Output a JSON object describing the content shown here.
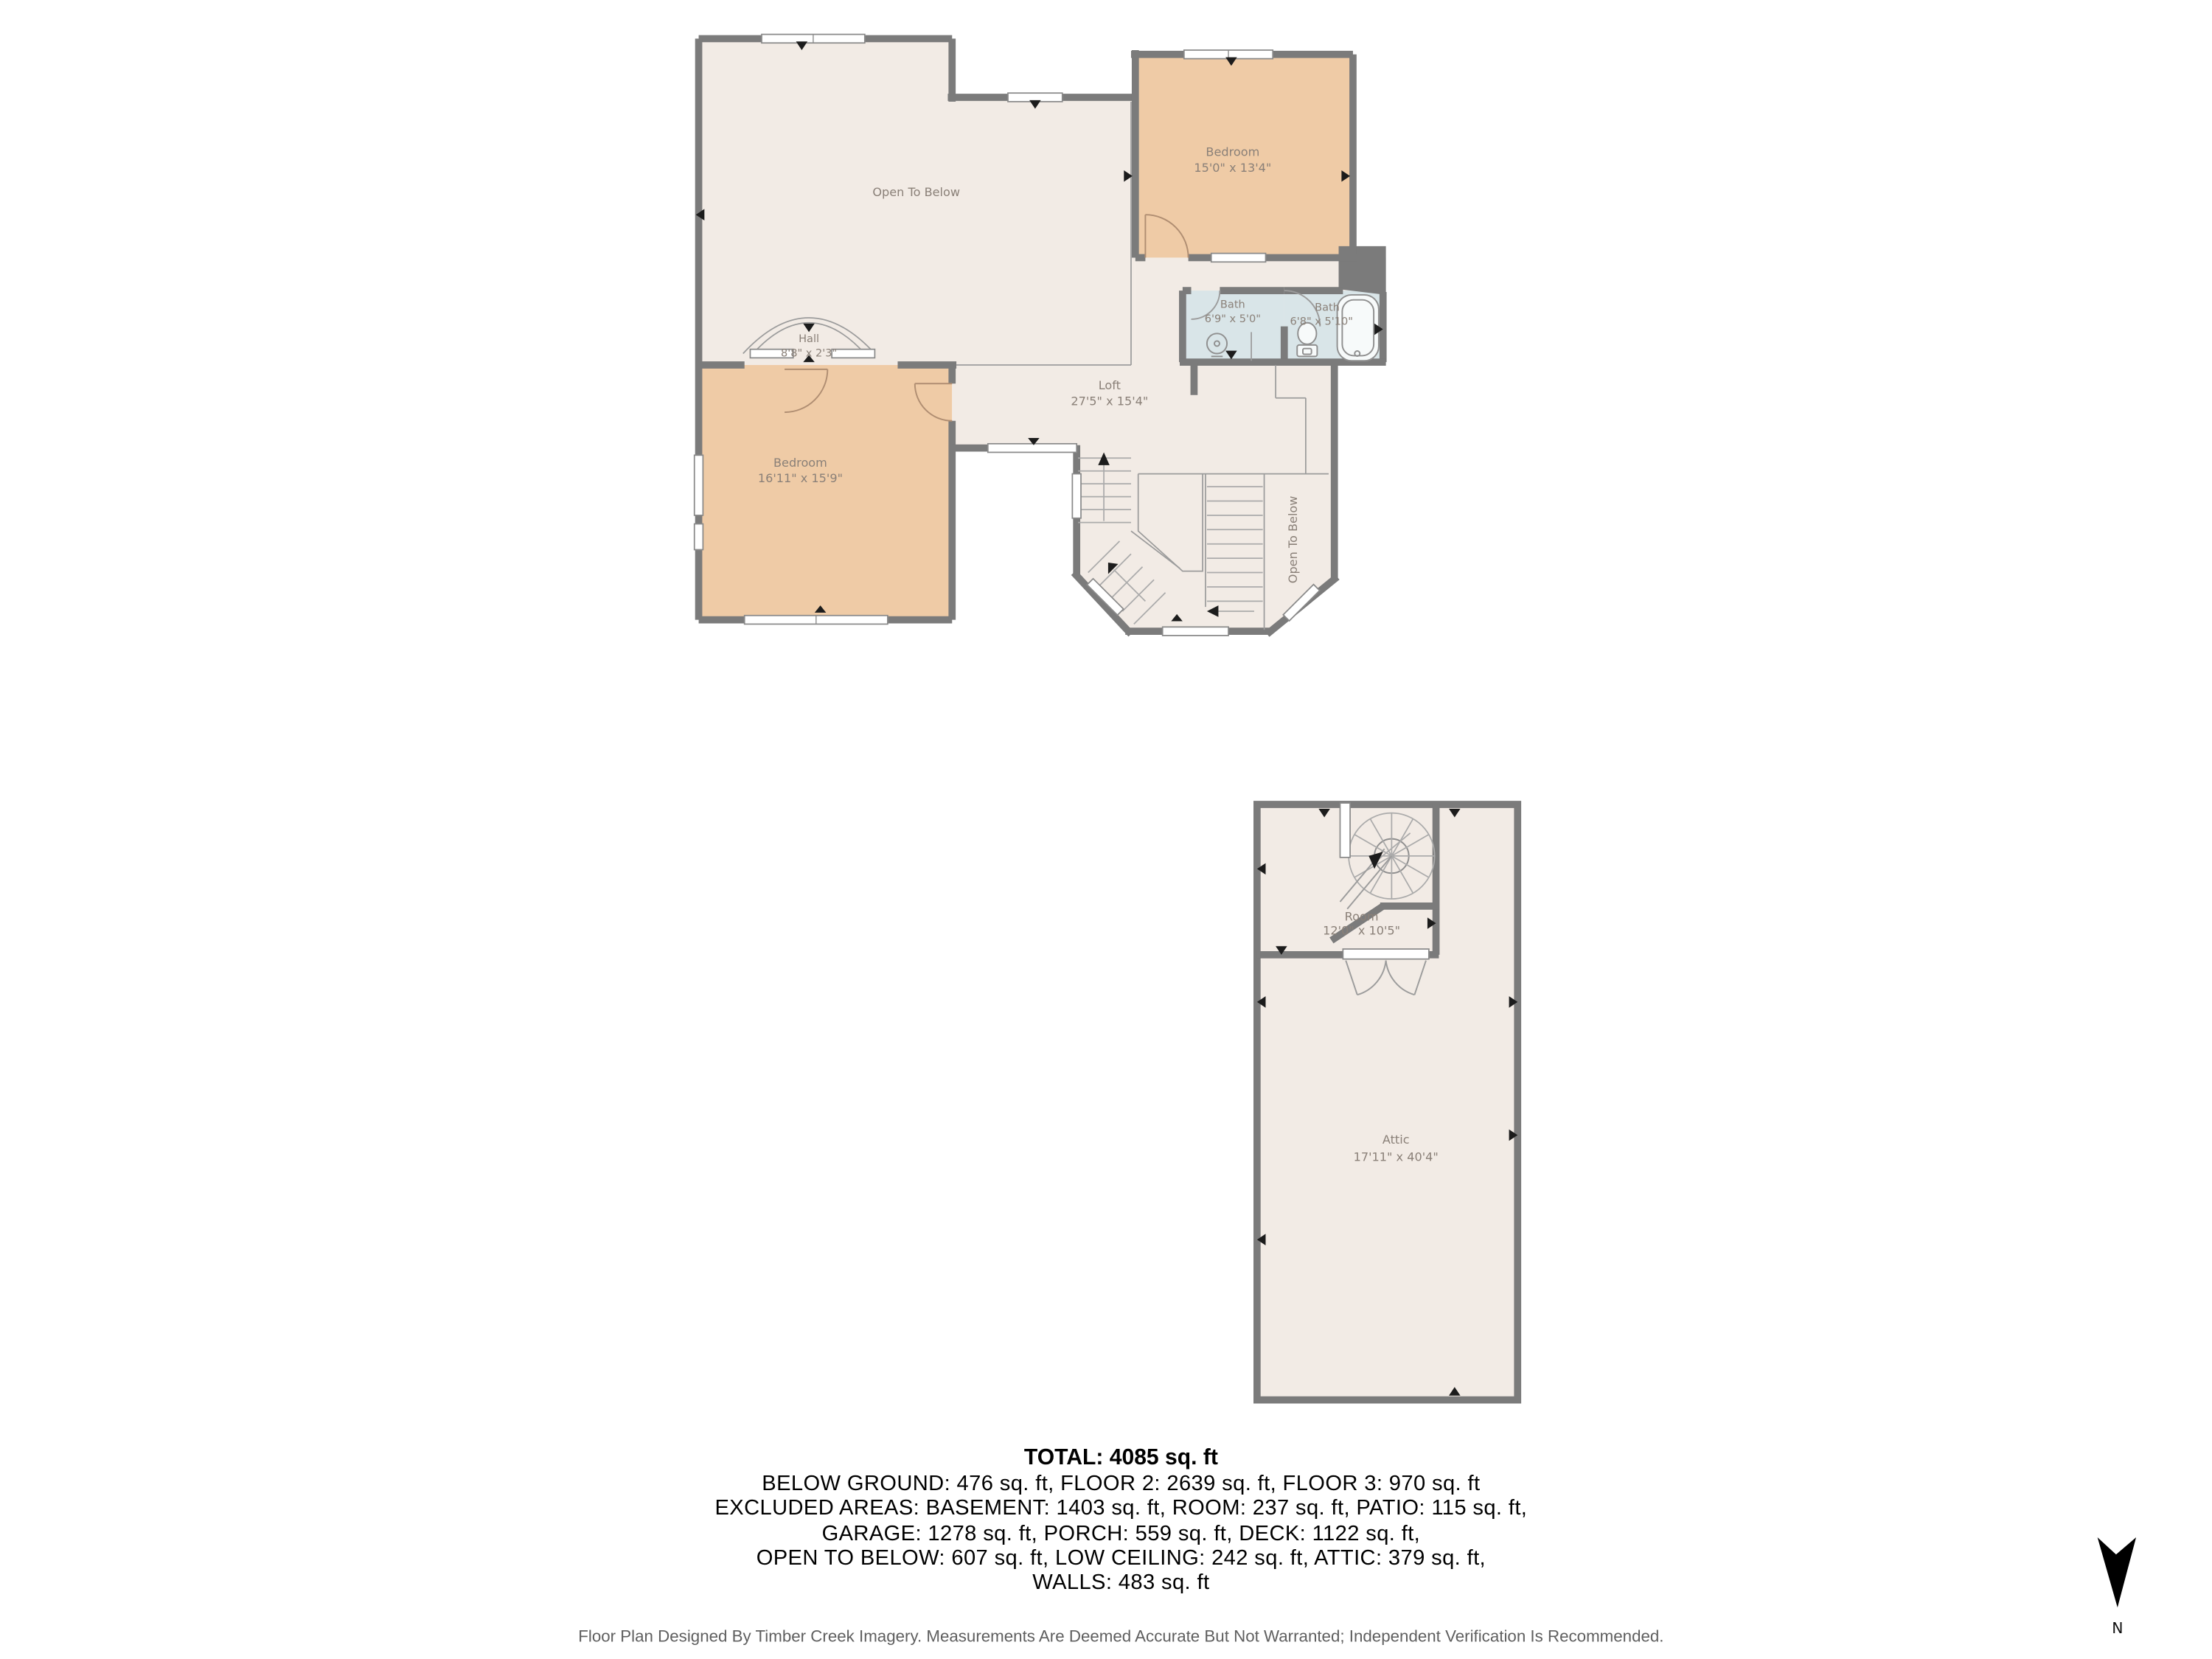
{
  "floor2": {
    "open_to_below": "Open To Below",
    "bedroom1": {
      "name": "Bedroom",
      "dims": "15'0\" x 13'4\""
    },
    "bath1": {
      "name": "Bath",
      "dims": "6'9\" x 5'0\""
    },
    "bath2": {
      "name": "Bath",
      "dims": "6'8\" x 5'10\""
    },
    "hall": {
      "name": "Hall",
      "dims": "8'8\" x 2'3\""
    },
    "loft": {
      "name": "Loft",
      "dims": "27'5\" x 15'4\""
    },
    "bedroom2": {
      "name": "Bedroom",
      "dims": "16'11\" x 15'9\""
    },
    "open_to_below_stair": "Open To Below"
  },
  "floor3": {
    "room": {
      "name": "Room",
      "dims": "12'0\" x 10'5\""
    },
    "attic": {
      "name": "Attic",
      "dims": "17'11\" x 40'4\""
    }
  },
  "summary": {
    "total": "TOTAL: 4085 sq. ft",
    "line2": "BELOW GROUND: 476 sq. ft, FLOOR 2: 2639 sq. ft, FLOOR 3: 970 sq. ft",
    "line3": "EXCLUDED AREAS: BASEMENT: 1403 sq. ft, ROOM: 237 sq. ft, PATIO: 115 sq. ft,",
    "line4": "GARAGE: 1278 sq. ft, PORCH: 559 sq. ft, DECK: 1122 sq. ft,",
    "line5": "OPEN TO BELOW: 607 sq. ft, LOW CEILING: 242 sq. ft, ATTIC: 379 sq. ft,",
    "line6": "WALLS: 483 sq. ft"
  },
  "footer": {
    "disclaimer": "Floor Plan Designed By Timber Creek Imagery. Measurements Are Deemed Accurate But Not Warranted; Independent Verification Is Recommended."
  },
  "compass": {
    "label": "N"
  },
  "colors": {
    "wall": "#7b7b7b",
    "room_cream": "#f2ebe5",
    "room_tan": "#efcba6",
    "room_bath": "#d9e5e8",
    "label_text": "#8a8078"
  }
}
